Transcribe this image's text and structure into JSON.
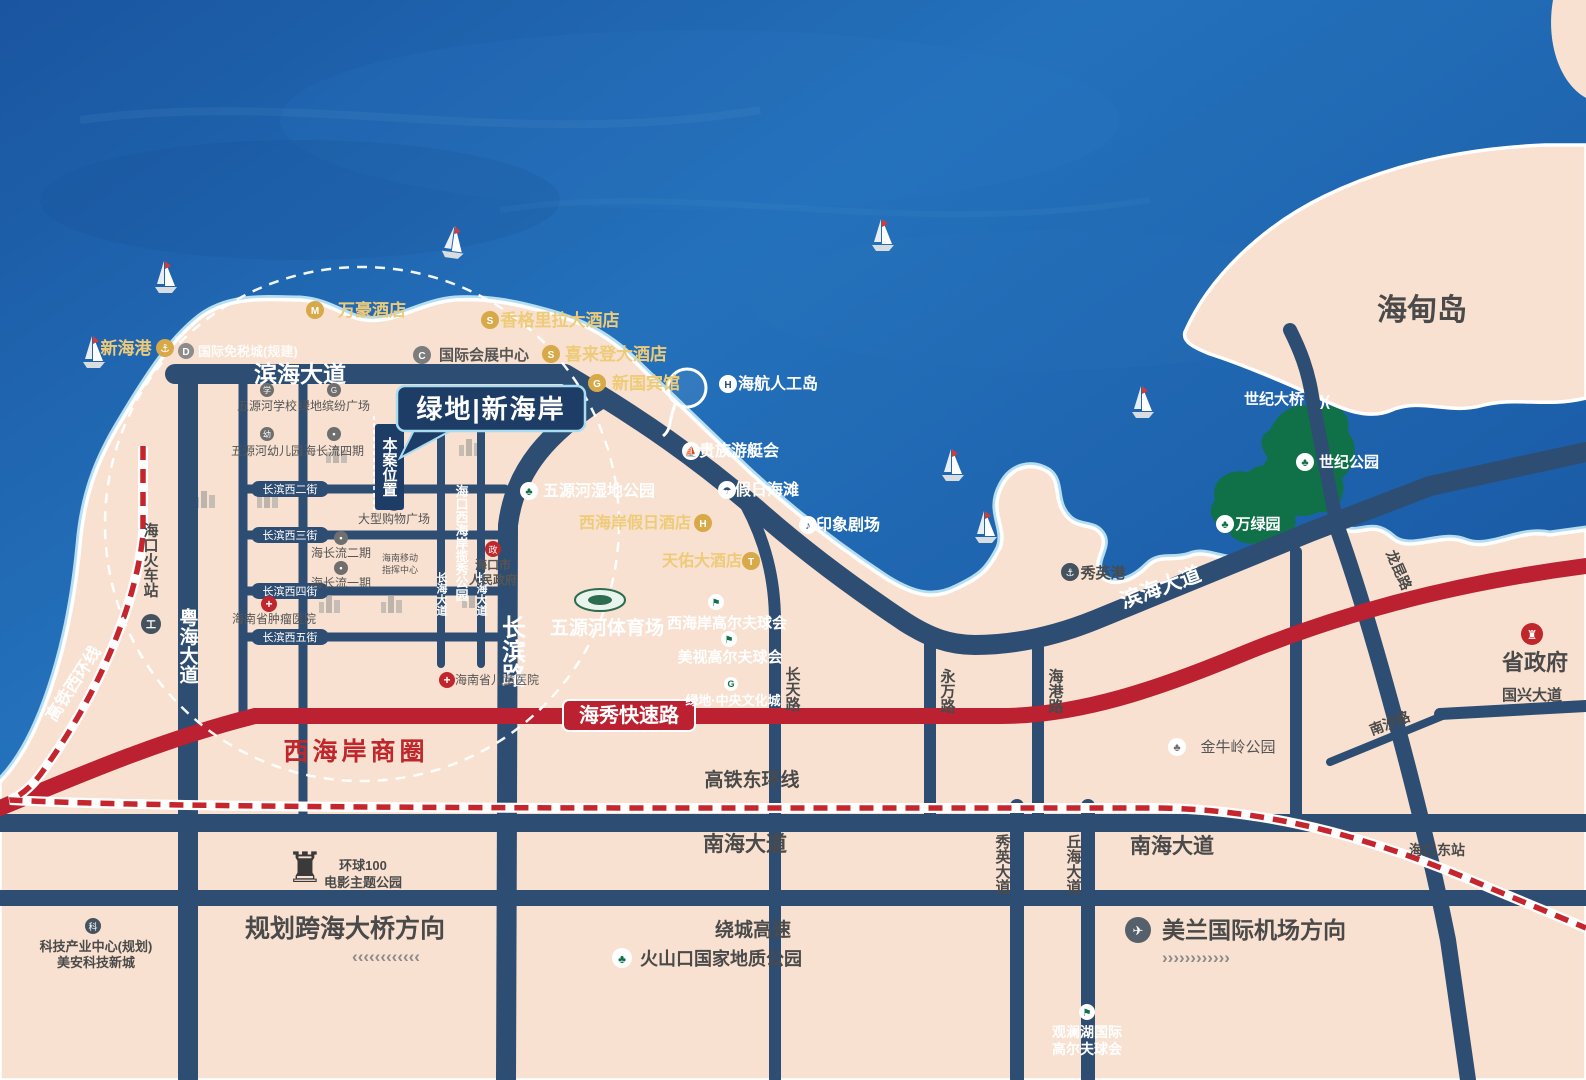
{
  "colors": {
    "ocean": "#1e63ab",
    "land": "#f8e1d0",
    "park_green": "#107149",
    "road_navy": "#2e4d72",
    "expressway_red": "#bb2130",
    "gold_text": "#eecb79",
    "dark_label": "#4a4a4a",
    "business_circle_fill": "#cfdee8",
    "project_navy": "#1d3d66"
  },
  "project": {
    "name": "绿地|新海岸",
    "site_marker": "本案位置",
    "business_circle": "西海岸商圈"
  },
  "roads": {
    "binhai": "滨海大道",
    "yuehai": "粤海大道",
    "changbin": "长滨路",
    "changhai": "长海大道",
    "changtian": "长天路",
    "yongwan": "永万路",
    "haigang": "海港路",
    "xiuying_ave": "秀英大道",
    "qiuhai": "丘海大道",
    "longkun": "龙昆路",
    "nansha": "南沙路",
    "guoxing": "国兴大道",
    "nanhai": "南海大道",
    "haixiu": "海秀快速路",
    "raocheng": "绕城高速",
    "hsr_east": "高铁东环线",
    "hsr_west": "高铁西环线"
  },
  "streets": {
    "w2": "长滨西二街",
    "w3": "长滨西三街",
    "w4": "长滨西四街",
    "w5": "长滨西五街"
  },
  "directions": {
    "bridge": "规划跨海大桥方向",
    "airport": "美兰国际机场方向",
    "chevrons_left": "‹‹‹‹‹‹‹‹‹‹‹‹",
    "chevrons_right": "››››››››››››"
  },
  "transit": {
    "railway_station": "海口火车站",
    "east_station": "海口东站",
    "xinhai_port": "新海港",
    "xiuying_port": "秀英港",
    "century_bridge": "世纪大桥"
  },
  "hotels": {
    "marriott": "万豪酒店",
    "shangrila": "香格里拉大酒店",
    "sheraton": "喜来登大酒店",
    "guesthouse": "新国宾馆",
    "holiday_inn": "西海岸假日酒店",
    "tianyou": "天佑大酒店"
  },
  "attractions": {
    "duty_free": "国际免税城(规建)",
    "convention": "国际会展中心",
    "hna_island": "海航人工岛",
    "yacht_club": "贵族游艇会",
    "holiday_beach": "假日海滩",
    "impression": "印象剧场",
    "movie1": "环球100",
    "movie2": "电影主题公园",
    "volcano": "火山口国家地质公园",
    "mh1": "观澜湖国际",
    "mh2": "高尔夫球会",
    "wc_golf": "西海岸高尔夫球会",
    "ms_golf": "美视高尔夫球会",
    "stadium": "五源河体育场"
  },
  "parks": {
    "wetland": "五源河湿地公园",
    "ribbon": "海口西海岸揽秀公园",
    "century": "世纪公园",
    "wanlv": "万绿园",
    "jinniuling": "金牛岭公园"
  },
  "places": {
    "haidian": "海甸岛",
    "prov_gov": "省政府",
    "city_gov1": "海口市",
    "city_gov2": "人民政府",
    "school": "五源河学校",
    "kindergarten": "五源河幼儿园",
    "lvdi_plaza": "绿地缤纷广场",
    "hcl4": "海长流四期",
    "hcl2": "海长流二期",
    "hcl1": "海长流一期",
    "mall": "大型购物广场",
    "mobile1": "海南移动",
    "mobile2": "指挥中心",
    "tumor_hosp": "海南省肿瘤医院",
    "child_hosp": "海南省儿童医院",
    "culture_city": "绿地·中央文化城",
    "tech1": "科技产业中心(规划)",
    "tech2": "美安科技新城"
  },
  "icons": {
    "anchor": "⚓",
    "tree": "♣",
    "cross": "+",
    "plane": "✈",
    "flag": "⚑",
    "umbrella": "☂",
    "sail": "⛵",
    "note": "♪",
    "castle": "♜",
    "bank": "♜",
    "train": "工",
    "dot": "•",
    "school_g": "学",
    "kinder_g": "幼",
    "mall_g": "购",
    "gov_g": "政",
    "tech_g": "科",
    "m": "M",
    "s": "S",
    "h": "H",
    "t": "T",
    "g": "G",
    "c": "C",
    "d": "D",
    "bridge_glyph": ")("
  }
}
